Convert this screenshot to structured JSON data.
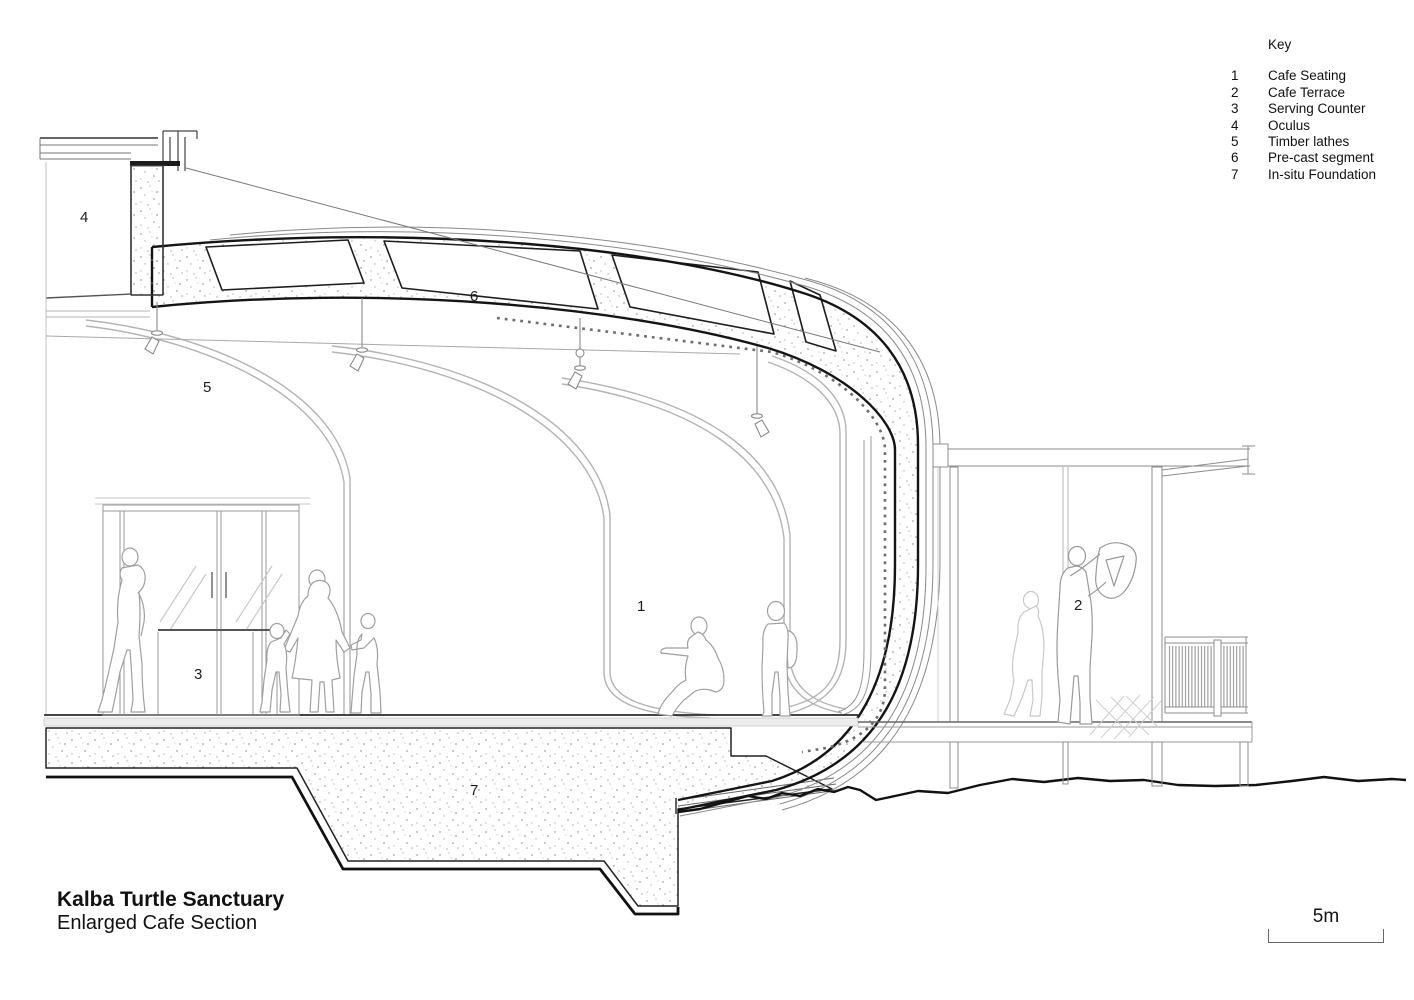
{
  "title_block": {
    "project_title": "Kalba Turtle Sanctuary",
    "drawing_title": "Enlarged Cafe Section"
  },
  "key": {
    "heading": "Key",
    "items": [
      {
        "num": "1",
        "label": "Cafe Seating"
      },
      {
        "num": "2",
        "label": "Cafe Terrace"
      },
      {
        "num": "3",
        "label": "Serving Counter"
      },
      {
        "num": "4",
        "label": "Oculus"
      },
      {
        "num": "5",
        "label": "Timber lathes"
      },
      {
        "num": "6",
        "label": "Pre-cast segment"
      },
      {
        "num": "7",
        "label": "In-situ Foundation"
      }
    ]
  },
  "scale_bar": {
    "label": "5m"
  },
  "section_labels": {
    "cafe_seating": "1",
    "cafe_terrace": "2",
    "serving_counter": "3",
    "oculus": "4",
    "timber_lathes": "5",
    "precast_segment": "6",
    "insitu_foundation": "7"
  },
  "colors": {
    "line_dark": "#141414",
    "line_medium": "#666666",
    "line_light": "#b3b3b3",
    "stipple": "#a8a8a8",
    "background": "#ffffff"
  }
}
